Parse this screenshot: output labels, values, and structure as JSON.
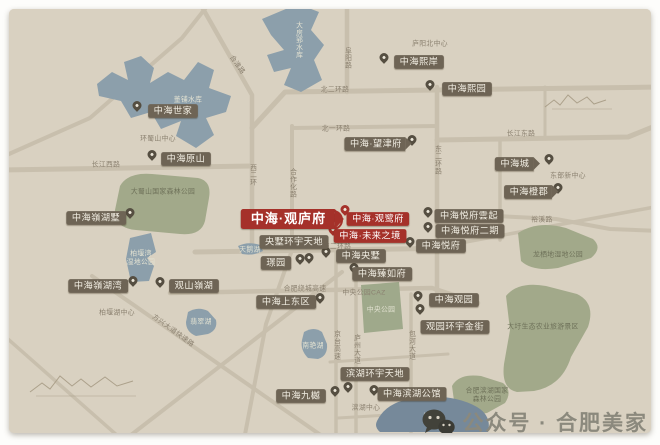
{
  "watermark": {
    "icon": "wechat-icon",
    "text": "公众号 · 合肥美家"
  },
  "map": {
    "accent_red": "#a5312a",
    "label_brown": "#6e6455",
    "icons": {
      "pin": "location-pin-icon",
      "highlight": "highlight-ring"
    },
    "highlighted_project": "中海·观庐府",
    "projects": [
      {
        "name": "中海世家",
        "x": 173,
        "y": 111,
        "variant": "pill"
      },
      {
        "name": "中海原山",
        "x": 186,
        "y": 159,
        "variant": "pill"
      },
      {
        "name": "中海熙岸",
        "x": 419,
        "y": 62,
        "variant": "pill"
      },
      {
        "name": "中海熙园",
        "x": 467,
        "y": 89,
        "variant": "pill"
      },
      {
        "name": "中海·望津府",
        "x": 375,
        "y": 144,
        "variant": "banner"
      },
      {
        "name": "中海城",
        "x": 514,
        "y": 164,
        "variant": "banner"
      },
      {
        "name": "中海橙郡",
        "x": 528,
        "y": 192,
        "variant": "banner"
      },
      {
        "name": "中海悦府雲起",
        "x": 469,
        "y": 216,
        "variant": "pill"
      },
      {
        "name": "中海悦府二期",
        "x": 470,
        "y": 231,
        "variant": "pill"
      },
      {
        "name": "中海悦府",
        "x": 441,
        "y": 246,
        "variant": "pill"
      },
      {
        "name": "中海·观庐府",
        "x": 288,
        "y": 219,
        "variant": "red-banner"
      },
      {
        "name": "中海·观鹭府",
        "x": 378,
        "y": 219,
        "variant": "red-pill"
      },
      {
        "name": "中海·未来之境",
        "x": 370,
        "y": 236,
        "variant": "red-pill"
      },
      {
        "name": "央墅环宇天地",
        "x": 294,
        "y": 242,
        "variant": "pill"
      },
      {
        "name": "璟园",
        "x": 276,
        "y": 263,
        "variant": "pill"
      },
      {
        "name": "中海央墅",
        "x": 361,
        "y": 256,
        "variant": "pill"
      },
      {
        "name": "中海臻如府",
        "x": 382,
        "y": 274,
        "variant": "pill"
      },
      {
        "name": "中海上东区",
        "x": 286,
        "y": 302,
        "variant": "pill"
      },
      {
        "name": "中海嶺湖墅",
        "x": 96,
        "y": 218,
        "variant": "pill"
      },
      {
        "name": "中海嶺湖湾",
        "x": 98,
        "y": 286,
        "variant": "pill"
      },
      {
        "name": "观山嶺湖",
        "x": 194,
        "y": 286,
        "variant": "pill"
      },
      {
        "name": "中海观园",
        "x": 454,
        "y": 300,
        "variant": "pill"
      },
      {
        "name": "观园环宇金街",
        "x": 455,
        "y": 327,
        "variant": "pill"
      },
      {
        "name": "滨湖环宇天地",
        "x": 375,
        "y": 374,
        "variant": "pill"
      },
      {
        "name": "中海滨湖公馆",
        "x": 412,
        "y": 394,
        "variant": "pill"
      },
      {
        "name": "中海九樾",
        "x": 301,
        "y": 396,
        "variant": "pill"
      }
    ],
    "pins": [
      {
        "x": 137,
        "y": 110
      },
      {
        "x": 152,
        "y": 159
      },
      {
        "x": 384,
        "y": 62
      },
      {
        "x": 430,
        "y": 89
      },
      {
        "x": 412,
        "y": 144
      },
      {
        "x": 549,
        "y": 163
      },
      {
        "x": 558,
        "y": 192
      },
      {
        "x": 428,
        "y": 216
      },
      {
        "x": 428,
        "y": 231
      },
      {
        "x": 410,
        "y": 246
      },
      {
        "x": 333,
        "y": 222,
        "red": true,
        "ring": true
      },
      {
        "x": 345,
        "y": 214,
        "red": true
      },
      {
        "x": 333,
        "y": 234,
        "red": true
      },
      {
        "x": 326,
        "y": 256
      },
      {
        "x": 309,
        "y": 262
      },
      {
        "x": 300,
        "y": 263
      },
      {
        "x": 354,
        "y": 272
      },
      {
        "x": 320,
        "y": 302
      },
      {
        "x": 130,
        "y": 217
      },
      {
        "x": 133,
        "y": 285
      },
      {
        "x": 160,
        "y": 286
      },
      {
        "x": 418,
        "y": 300
      },
      {
        "x": 420,
        "y": 313
      },
      {
        "x": 335,
        "y": 395
      },
      {
        "x": 348,
        "y": 391
      },
      {
        "x": 374,
        "y": 394
      }
    ],
    "road_labels": [
      {
        "text": "北二环路",
        "x": 335,
        "y": 90
      },
      {
        "text": "北一环路",
        "x": 336,
        "y": 129
      },
      {
        "text": "长江东路",
        "x": 521,
        "y": 134
      },
      {
        "text": "长江西路",
        "x": 106,
        "y": 165
      },
      {
        "text": "南二环路",
        "x": 337,
        "y": 247
      },
      {
        "text": "合肥绕城高速",
        "x": 305,
        "y": 289
      },
      {
        "text": "裕溪路",
        "x": 542,
        "y": 220
      },
      {
        "text": "合淮路",
        "x": 237,
        "y": 65,
        "rot": 55
      },
      {
        "text": "阜阳路",
        "x": 347,
        "y": 58,
        "vertical": true
      },
      {
        "text": "东二环路",
        "x": 437,
        "y": 160,
        "vertical": true
      },
      {
        "text": "西二环",
        "x": 252,
        "y": 175,
        "vertical": true
      },
      {
        "text": "合作化路",
        "x": 292,
        "y": 183,
        "vertical": true
      },
      {
        "text": "京台高速",
        "x": 336,
        "y": 345,
        "vertical": true
      },
      {
        "text": "庐州大道",
        "x": 356,
        "y": 349,
        "vertical": true
      },
      {
        "text": "包河大道",
        "x": 411,
        "y": 345,
        "vertical": true
      },
      {
        "text": "方兴大道快速路",
        "x": 173,
        "y": 331,
        "rot": 36
      }
    ],
    "area_labels": [
      {
        "text": "庐阳北中心",
        "x": 430,
        "y": 44,
        "tone": "dark"
      },
      {
        "text": "环蜀山中心",
        "x": 158,
        "y": 139,
        "tone": "dark"
      },
      {
        "text": "东部新中心",
        "x": 568,
        "y": 176,
        "tone": "dark"
      },
      {
        "text": "柏堰湖中心",
        "x": 117,
        "y": 313,
        "tone": "dark"
      },
      {
        "text": "滨湖中心",
        "x": 366,
        "y": 408,
        "tone": "dark"
      },
      {
        "text": "中央公园CAZ",
        "x": 364,
        "y": 293,
        "tone": "dark"
      },
      {
        "text": "董铺水库",
        "x": 188,
        "y": 100,
        "tone": "light"
      },
      {
        "text": "大房郢水库",
        "x": 298,
        "y": 40,
        "tone": "light",
        "vertical": true
      },
      {
        "text": "天鹅湖",
        "x": 250,
        "y": 250,
        "tone": "light"
      },
      {
        "text": "翡翠湖",
        "x": 201,
        "y": 322,
        "tone": "light"
      },
      {
        "text": "南艳湖",
        "x": 313,
        "y": 346,
        "tone": "light"
      },
      {
        "text": "巢湖",
        "x": 430,
        "y": 417,
        "tone": "light"
      },
      {
        "text": "大蜀山国家森林公园",
        "x": 163,
        "y": 192,
        "tone": "park"
      },
      {
        "text": "柏堰湾\n湿地公园",
        "x": 141,
        "y": 258,
        "tone": "light"
      },
      {
        "text": "中央公园",
        "x": 381,
        "y": 310,
        "tone": "light"
      },
      {
        "text": "龙栖地湿地公园",
        "x": 558,
        "y": 255,
        "tone": "park"
      },
      {
        "text": "大圩生态农业旅游景区",
        "x": 543,
        "y": 327,
        "tone": "park"
      },
      {
        "text": "合肥滨湖国家\n森林公园",
        "x": 487,
        "y": 395,
        "tone": "park"
      }
    ]
  }
}
